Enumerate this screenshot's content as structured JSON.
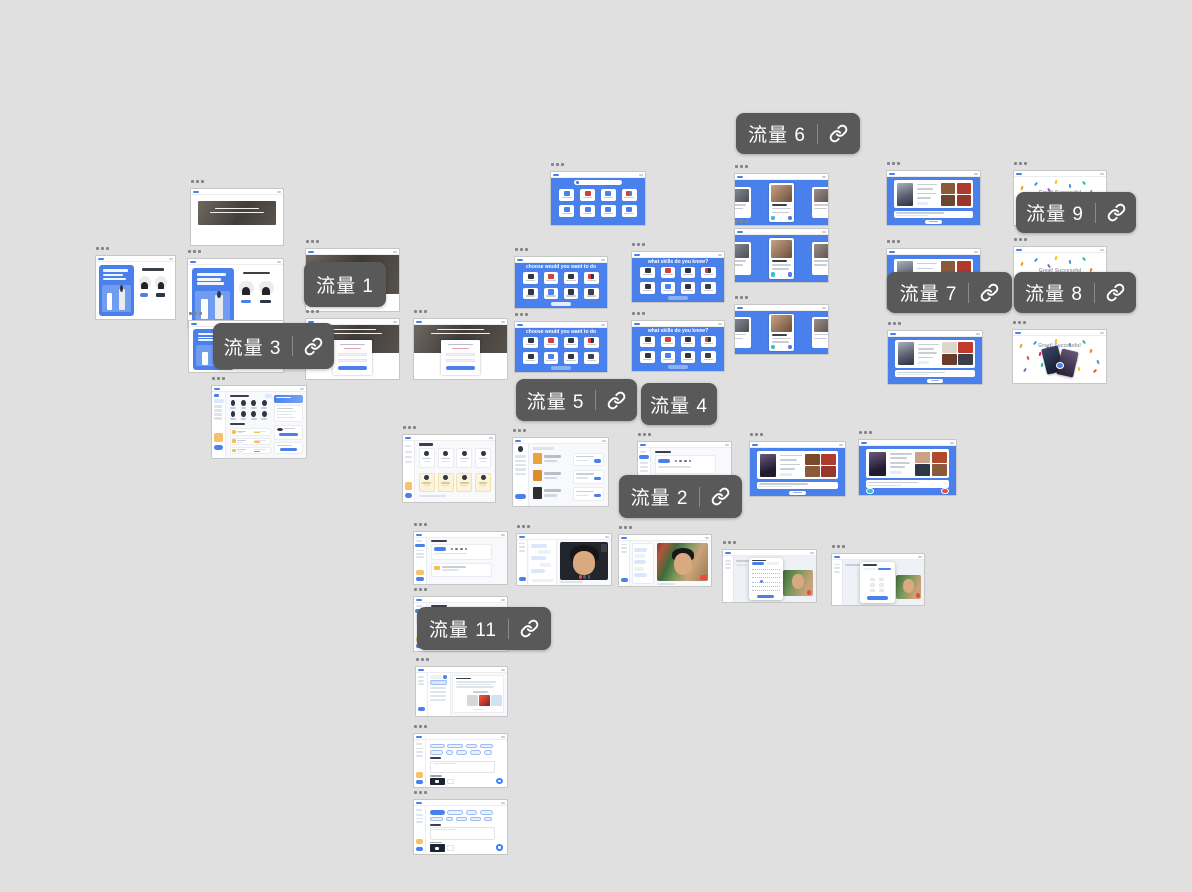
{
  "app": {
    "name": "prototype flow canvas"
  },
  "canvas": {
    "background_color": "#e0e0e0",
    "accent_blue": "#4a80ec",
    "label_style": {
      "background": "#595959",
      "text_color": "#ffffff",
      "divider_color": "#8a8a8a",
      "link_icon": "chain-link"
    },
    "handle_icon": "three-dots-menu",
    "screen_titles": {
      "grid_title_1": "choose would you want to do",
      "grid_title_2": "what skills do you know?",
      "success_title": "Great! Successful"
    },
    "flow_labels": [
      {
        "id": "flow-1",
        "text": "流量 1",
        "x": 304,
        "y": 262,
        "w": 82,
        "h": 45,
        "has_link": false
      },
      {
        "id": "flow-2",
        "text": "流量 2",
        "x": 619,
        "y": 475,
        "w": 123,
        "h": 43,
        "has_link": true
      },
      {
        "id": "flow-3",
        "text": "流量 3",
        "x": 213,
        "y": 323,
        "w": 121,
        "h": 46,
        "has_link": true
      },
      {
        "id": "flow-4",
        "text": "流量 4",
        "x": 641,
        "y": 383,
        "w": 76,
        "h": 42,
        "has_link": false
      },
      {
        "id": "flow-5",
        "text": "流量 5",
        "x": 516,
        "y": 379,
        "w": 121,
        "h": 42,
        "has_link": true
      },
      {
        "id": "flow-6",
        "text": "流量 6",
        "x": 736,
        "y": 113,
        "w": 124,
        "h": 41,
        "has_link": true
      },
      {
        "id": "flow-7",
        "text": "流量 7",
        "x": 887,
        "y": 272,
        "w": 125,
        "h": 41,
        "has_link": true
      },
      {
        "id": "flow-8",
        "text": "流量 8",
        "x": 1014,
        "y": 272,
        "w": 122,
        "h": 41,
        "has_link": true
      },
      {
        "id": "flow-9",
        "text": "流量 9",
        "x": 1016,
        "y": 192,
        "w": 120,
        "h": 41,
        "has_link": true
      },
      {
        "id": "flow-11",
        "text": "流量 11",
        "x": 417,
        "y": 607,
        "w": 134,
        "h": 43,
        "has_link": true
      }
    ],
    "screens": [
      {
        "id": "s1",
        "kind": "hero_banner",
        "x": 190,
        "y": 188,
        "w": 94,
        "h": 58
      },
      {
        "id": "s2",
        "kind": "split_landing",
        "x": 95,
        "y": 255,
        "w": 81,
        "h": 65
      },
      {
        "id": "s3",
        "kind": "split_landing",
        "x": 187,
        "y": 258,
        "w": 97,
        "h": 71
      },
      {
        "id": "s4",
        "kind": "photo_page",
        "x": 305,
        "y": 248,
        "w": 95,
        "h": 64
      },
      {
        "id": "s5",
        "kind": "split_landing",
        "x": 188,
        "y": 320,
        "w": 96,
        "h": 53
      },
      {
        "id": "s6",
        "kind": "photo_login",
        "x": 305,
        "y": 318,
        "w": 95,
        "h": 62
      },
      {
        "id": "s7",
        "kind": "photo_login",
        "x": 413,
        "y": 318,
        "w": 95,
        "h": 62
      },
      {
        "id": "s8",
        "kind": "dashboard_home",
        "x": 211,
        "y": 385,
        "w": 96,
        "h": 74
      },
      {
        "id": "s9",
        "kind": "blue_search_grid",
        "x": 550,
        "y": 171,
        "w": 96,
        "h": 55
      },
      {
        "id": "s10",
        "kind": "blue_grid",
        "x": 514,
        "y": 256,
        "w": 94,
        "h": 53,
        "title_key": "grid_title_1",
        "variant": "light"
      },
      {
        "id": "s11",
        "kind": "blue_grid",
        "x": 631,
        "y": 251,
        "w": 94,
        "h": 52,
        "title_key": "grid_title_2"
      },
      {
        "id": "s12",
        "kind": "blue_grid",
        "x": 514,
        "y": 321,
        "w": 94,
        "h": 52,
        "title_key": "grid_title_1"
      },
      {
        "id": "s13",
        "kind": "blue_grid",
        "x": 631,
        "y": 320,
        "w": 94,
        "h": 52,
        "title_key": "grid_title_2"
      },
      {
        "id": "s14",
        "kind": "blue_carousel",
        "x": 734,
        "y": 173,
        "w": 95,
        "h": 53
      },
      {
        "id": "s15",
        "kind": "blue_carousel",
        "x": 734,
        "y": 228,
        "w": 95,
        "h": 55
      },
      {
        "id": "s16",
        "kind": "blue_carousel",
        "x": 734,
        "y": 304,
        "w": 95,
        "h": 51
      },
      {
        "id": "s17",
        "kind": "blue_photo_form",
        "x": 886,
        "y": 170,
        "w": 95,
        "h": 56
      },
      {
        "id": "s18",
        "kind": "confetti",
        "x": 1013,
        "y": 170,
        "w": 94,
        "h": 56,
        "title_key": "success_title"
      },
      {
        "id": "s19",
        "kind": "blue_photo_form",
        "x": 886,
        "y": 248,
        "w": 95,
        "h": 62
      },
      {
        "id": "s20",
        "kind": "confetti",
        "x": 1013,
        "y": 246,
        "w": 94,
        "h": 60,
        "variant": "photo",
        "title_key": "success_title"
      },
      {
        "id": "s21",
        "kind": "blue_photo_form",
        "x": 887,
        "y": 330,
        "w": 96,
        "h": 55,
        "variant": "warm2"
      },
      {
        "id": "s22",
        "kind": "confetti_cards",
        "x": 1012,
        "y": 329,
        "w": 95,
        "h": 55,
        "title_key": "success_title"
      },
      {
        "id": "s23",
        "kind": "dashboard_cards",
        "x": 402,
        "y": 434,
        "w": 94,
        "h": 69
      },
      {
        "id": "s24",
        "kind": "dashboard_list",
        "x": 512,
        "y": 437,
        "w": 97,
        "h": 70
      },
      {
        "id": "s25",
        "kind": "dashboard_panel",
        "x": 637,
        "y": 441,
        "w": 95,
        "h": 64
      },
      {
        "id": "s26",
        "kind": "blue_photo_form",
        "x": 749,
        "y": 441,
        "w": 97,
        "h": 56,
        "variant": "profile"
      },
      {
        "id": "s27",
        "kind": "blue_photo_form",
        "x": 858,
        "y": 439,
        "w": 99,
        "h": 57,
        "variant": "actions"
      },
      {
        "id": "s28",
        "kind": "dashboard_panel",
        "x": 413,
        "y": 531,
        "w": 95,
        "h": 54
      },
      {
        "id": "s29",
        "kind": "video_call",
        "x": 516,
        "y": 533,
        "w": 96,
        "h": 53
      },
      {
        "id": "s30",
        "kind": "video_call",
        "x": 618,
        "y": 534,
        "w": 94,
        "h": 53,
        "variant": "big"
      },
      {
        "id": "s31",
        "kind": "calendar_modal",
        "x": 722,
        "y": 549,
        "w": 95,
        "h": 54
      },
      {
        "id": "s32",
        "kind": "time_modal",
        "x": 831,
        "y": 553,
        "w": 94,
        "h": 53
      },
      {
        "id": "s33",
        "kind": "dashboard_panel",
        "x": 413,
        "y": 596,
        "w": 95,
        "h": 56
      },
      {
        "id": "s34",
        "kind": "dashboard_detail",
        "x": 415,
        "y": 666,
        "w": 93,
        "h": 51
      },
      {
        "id": "s35",
        "kind": "pills_form",
        "x": 413,
        "y": 733,
        "w": 95,
        "h": 55
      },
      {
        "id": "s36",
        "kind": "pills_form",
        "x": 413,
        "y": 799,
        "w": 95,
        "h": 56,
        "variant": "active"
      }
    ]
  }
}
